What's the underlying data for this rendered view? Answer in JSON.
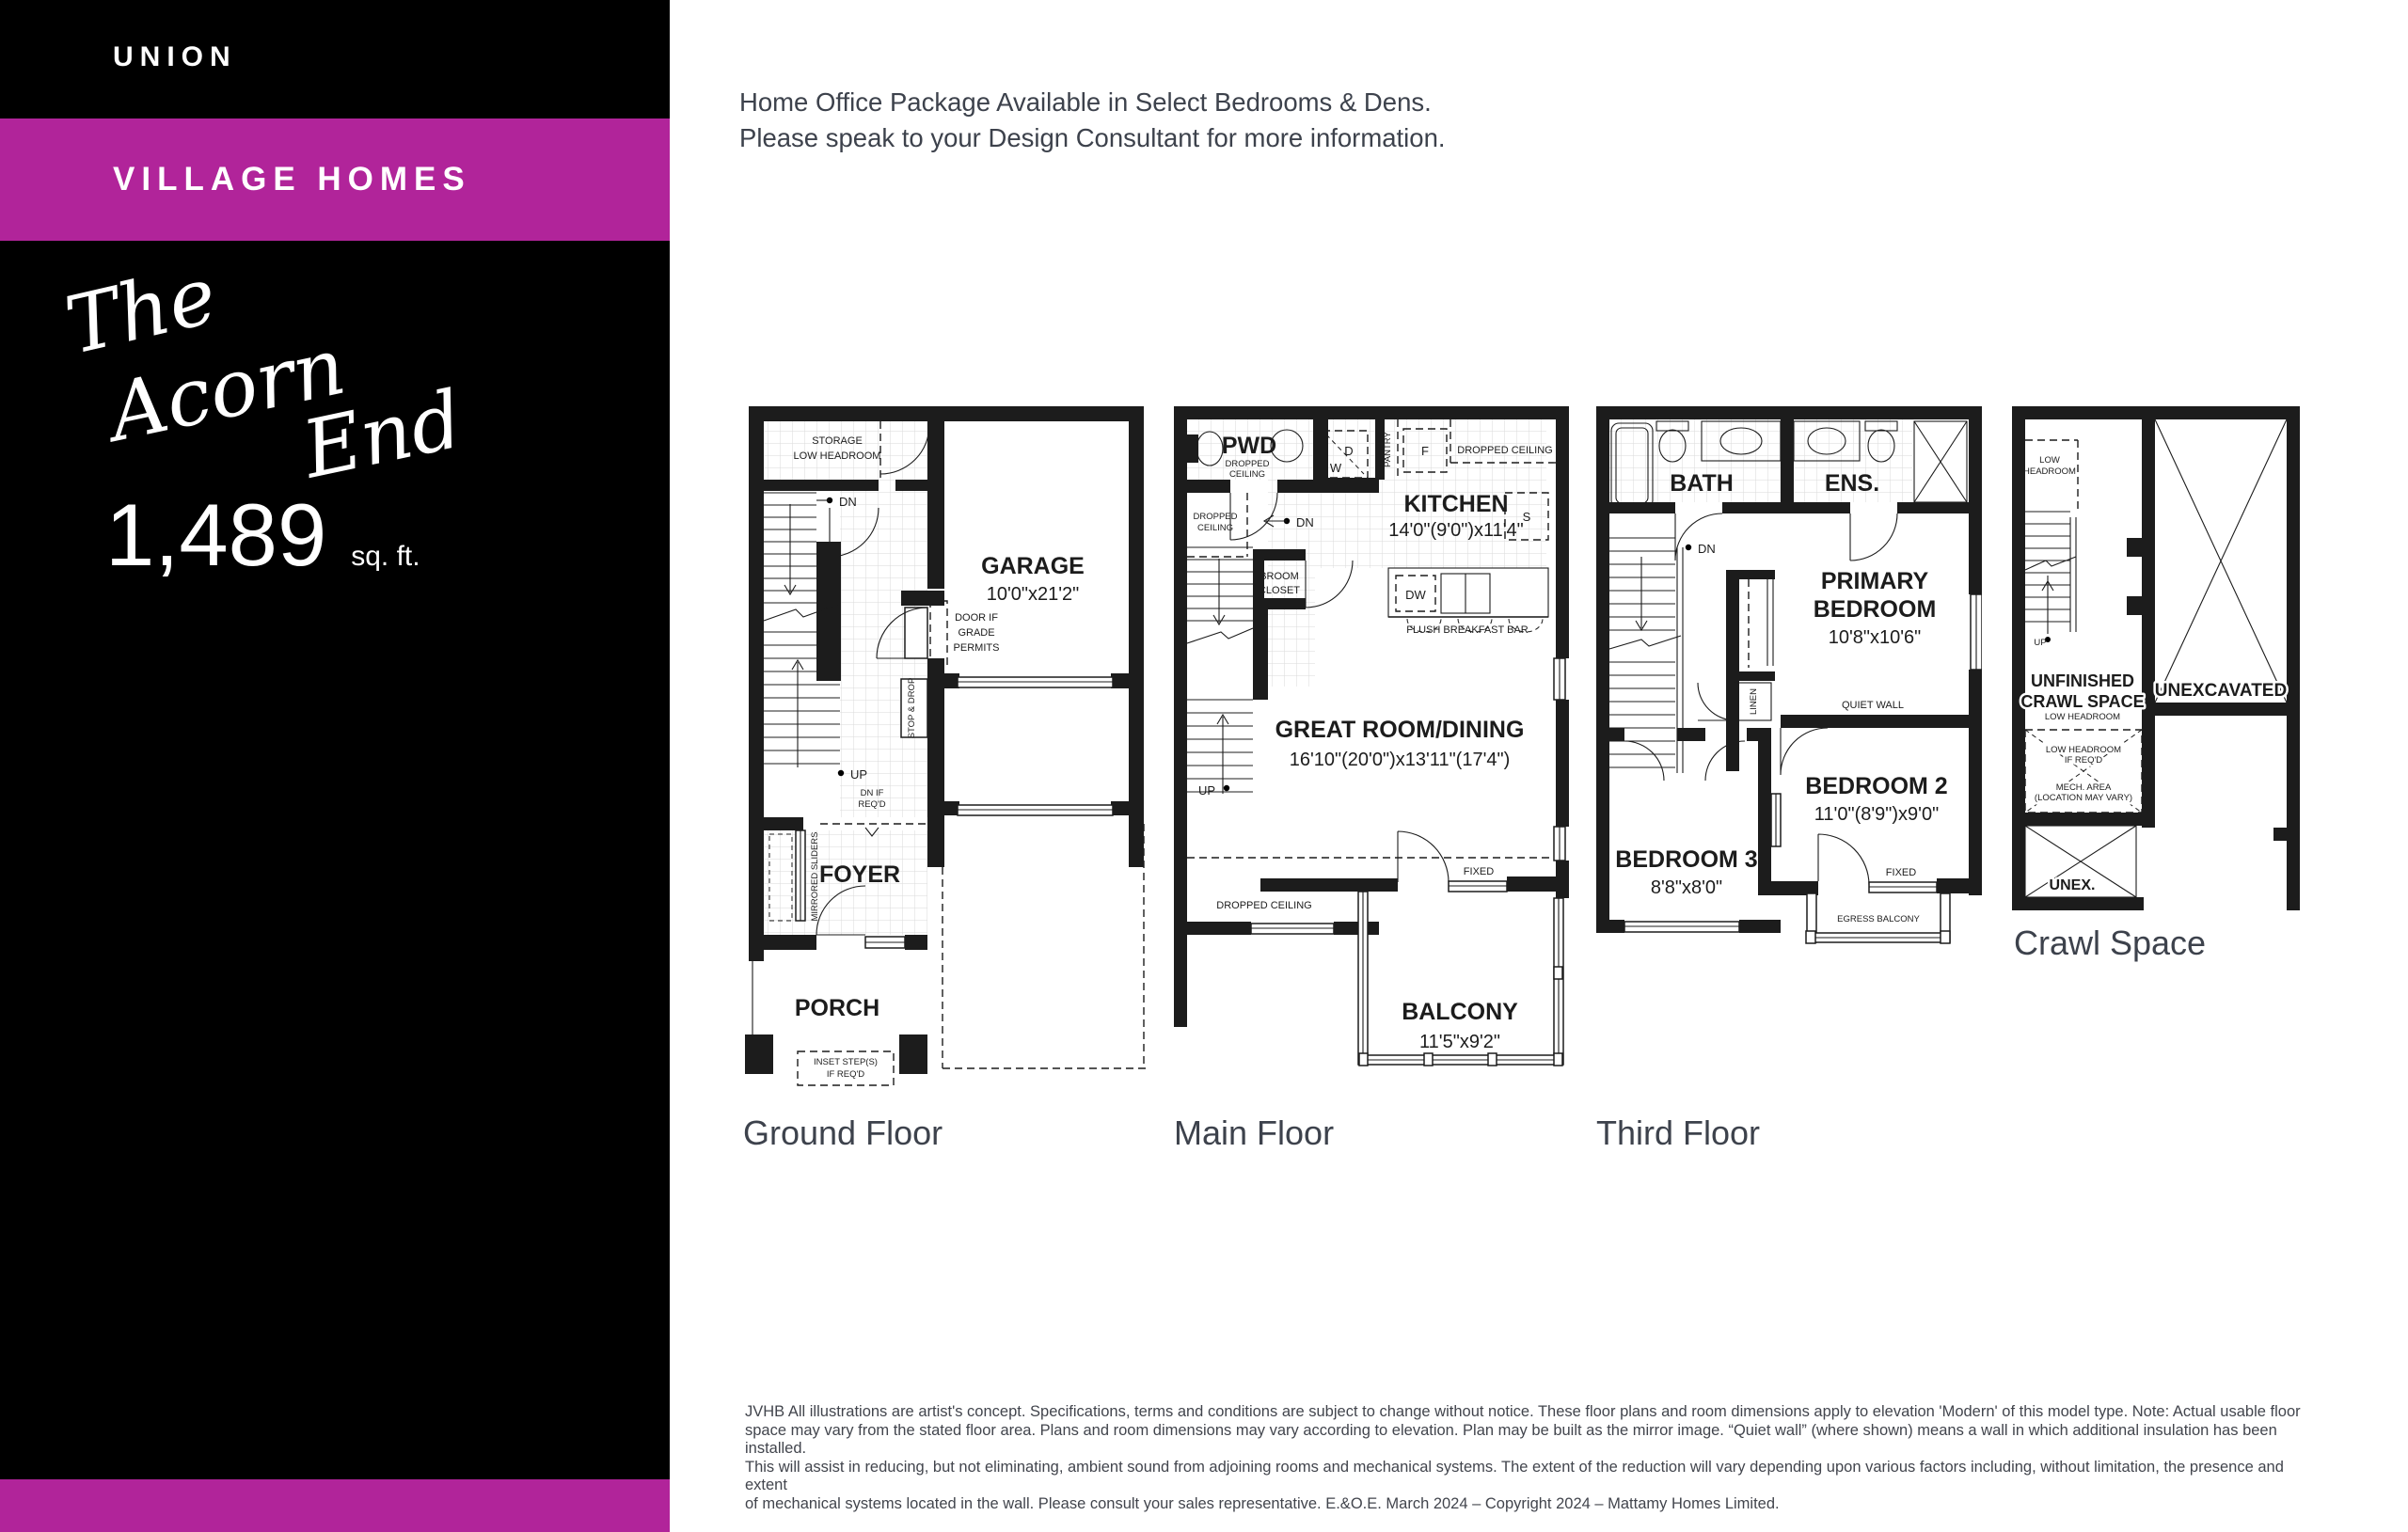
{
  "colors": {
    "accent": "#B1249A",
    "sidebar_bg": "#000000",
    "heading_text": "#3D424C",
    "plan_ink": "#1C1C1C"
  },
  "sidebar": {
    "brand": "UNION",
    "collection": "VILLAGE HOMES",
    "model": {
      "word1": "The",
      "word2": "Acorn",
      "word3": "End"
    },
    "area": {
      "value": "1,489",
      "unit": "sq. ft."
    }
  },
  "notice": {
    "line1": "Home Office Package Available in Select Bedrooms & Dens.",
    "line2": "Please speak to your Design Consultant for more information."
  },
  "plans": {
    "ground": {
      "caption": "Ground Floor",
      "storage": "STORAGE",
      "storage2": "LOW HEADROOM",
      "dn": "DN",
      "up": "UP",
      "garage": "GARAGE",
      "garage_dim": "10'0\"x21'2\"",
      "door_if": "DOOR IF",
      "grade": "GRADE",
      "permits": "PERMITS",
      "stop_drop": "STOP & DROP",
      "dn_if": "DN IF",
      "reqd": "REQ'D",
      "mirrored": "MIRRORED SLIDERS",
      "foyer": "FOYER",
      "porch": "PORCH",
      "inset": "INSET STEP(S)",
      "inset2": "IF REQ'D"
    },
    "main": {
      "caption": "Main Floor",
      "pwd": "PWD",
      "dc1": "DROPPED",
      "dc2": "CEILING",
      "d": "D",
      "w": "W",
      "pantry": "PANTRY",
      "f": "F",
      "dc_right": "DROPPED CEILING",
      "kitchen": "KITCHEN",
      "kitchen_dim": "14'0\"(9'0\")x11'4\"",
      "s": "S",
      "dn": "DN",
      "broom": "BROOM",
      "closet": "CLOSET",
      "dw": "DW",
      "bar": "FLUSH BREAKFAST BAR",
      "up": "UP",
      "great": "GREAT ROOM/DINING",
      "great_dim": "16'10\"(20'0\")x13'11\"(17'4\")",
      "dc_left1": "DROPPED",
      "dc_left2": "CEILING",
      "dc_bottom": "DROPPED CEILING",
      "fixed": "FIXED",
      "balcony": "BALCONY",
      "balcony_dim": "11'5\"x9'2\""
    },
    "third": {
      "caption": "Third Floor",
      "bath": "BATH",
      "ens": "ENS.",
      "dn": "DN",
      "primary1": "PRIMARY",
      "primary2": "BEDROOM",
      "primary_dim": "10'8\"x10'6\"",
      "linen": "LINEN",
      "quiet": "QUIET WALL",
      "bed2": "BEDROOM 2",
      "bed2_dim": "11'0\"(8'9\")x9'0\"",
      "bed3": "BEDROOM 3",
      "bed3_dim": "8'8\"x8'0\"",
      "fixed": "FIXED",
      "egress": "EGRESS BALCONY"
    },
    "crawl": {
      "caption": "Crawl Space",
      "low1": "LOW",
      "low2": "HEADROOM",
      "up": "UP",
      "unf1": "UNFINISHED",
      "unf2": "CRAWL SPACE",
      "unf3": "LOW HEADROOM",
      "lowreq1": "LOW HEADROOM",
      "lowreq2": "IF REQ'D",
      "mech1": "MECH. AREA",
      "mech2": "(LOCATION MAY VARY)",
      "unex": "UNEX.",
      "unexcavated": "UNEXCAVATED"
    }
  },
  "footer": {
    "line1": "JVHB All illustrations are artist's concept. Specifications, terms and conditions are subject to change without notice. These floor plans and room dimensions apply to elevation 'Modern' of this model type. Note: Actual usable floor",
    "line2": "space may vary from the stated floor area. Plans and room dimensions may vary according to elevation. Plan may be built as the mirror image. “Quiet wall” (where shown) means a wall in which additional insulation has been installed.",
    "line3": "This will assist in reducing, but not eliminating, ambient sound from adjoining rooms and mechanical systems. The extent of the reduction will vary depending upon various factors including, without limitation, the presence and extent",
    "line4": "of mechanical systems located in the wall. Please consult your sales representative. E.&O.E. March 2024 – Copyright 2024 – Mattamy Homes Limited."
  }
}
